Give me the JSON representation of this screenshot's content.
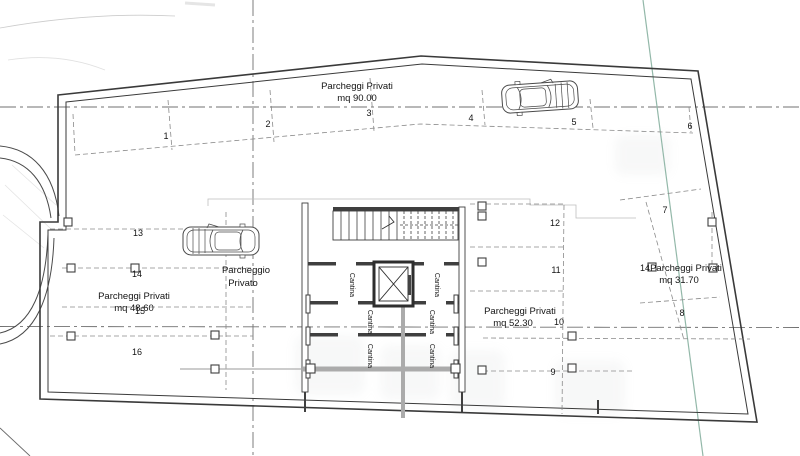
{
  "drawing": {
    "areas": {
      "top": {
        "line1": "Parcheggi Privati",
        "line2": "mq 90.00"
      },
      "left": {
        "line1": "Parcheggi Privati",
        "line2": "mq 48.60"
      },
      "center": {
        "line1": "Parcheggi Privati",
        "line2": "mq 52.30"
      },
      "right": {
        "line1": "Parcheggi Privati",
        "line2": "mq 31.70",
        "prefix": "14"
      },
      "private": {
        "line1": "Parcheggio",
        "line2": "Privato"
      }
    },
    "cellar_label": "Cantina",
    "spots": [
      "1",
      "2",
      "3",
      "4",
      "5",
      "6",
      "7",
      "8",
      "9",
      "10",
      "11",
      "12",
      "13",
      "14",
      "15",
      "16"
    ]
  },
  "colors": {
    "wall": "#3a3a3a",
    "dashed": "#8a8a8a",
    "axis": "#707070",
    "survey_line": "#93b8a9",
    "poche_gray": "#ababab",
    "faint": "#c6c6c6"
  }
}
